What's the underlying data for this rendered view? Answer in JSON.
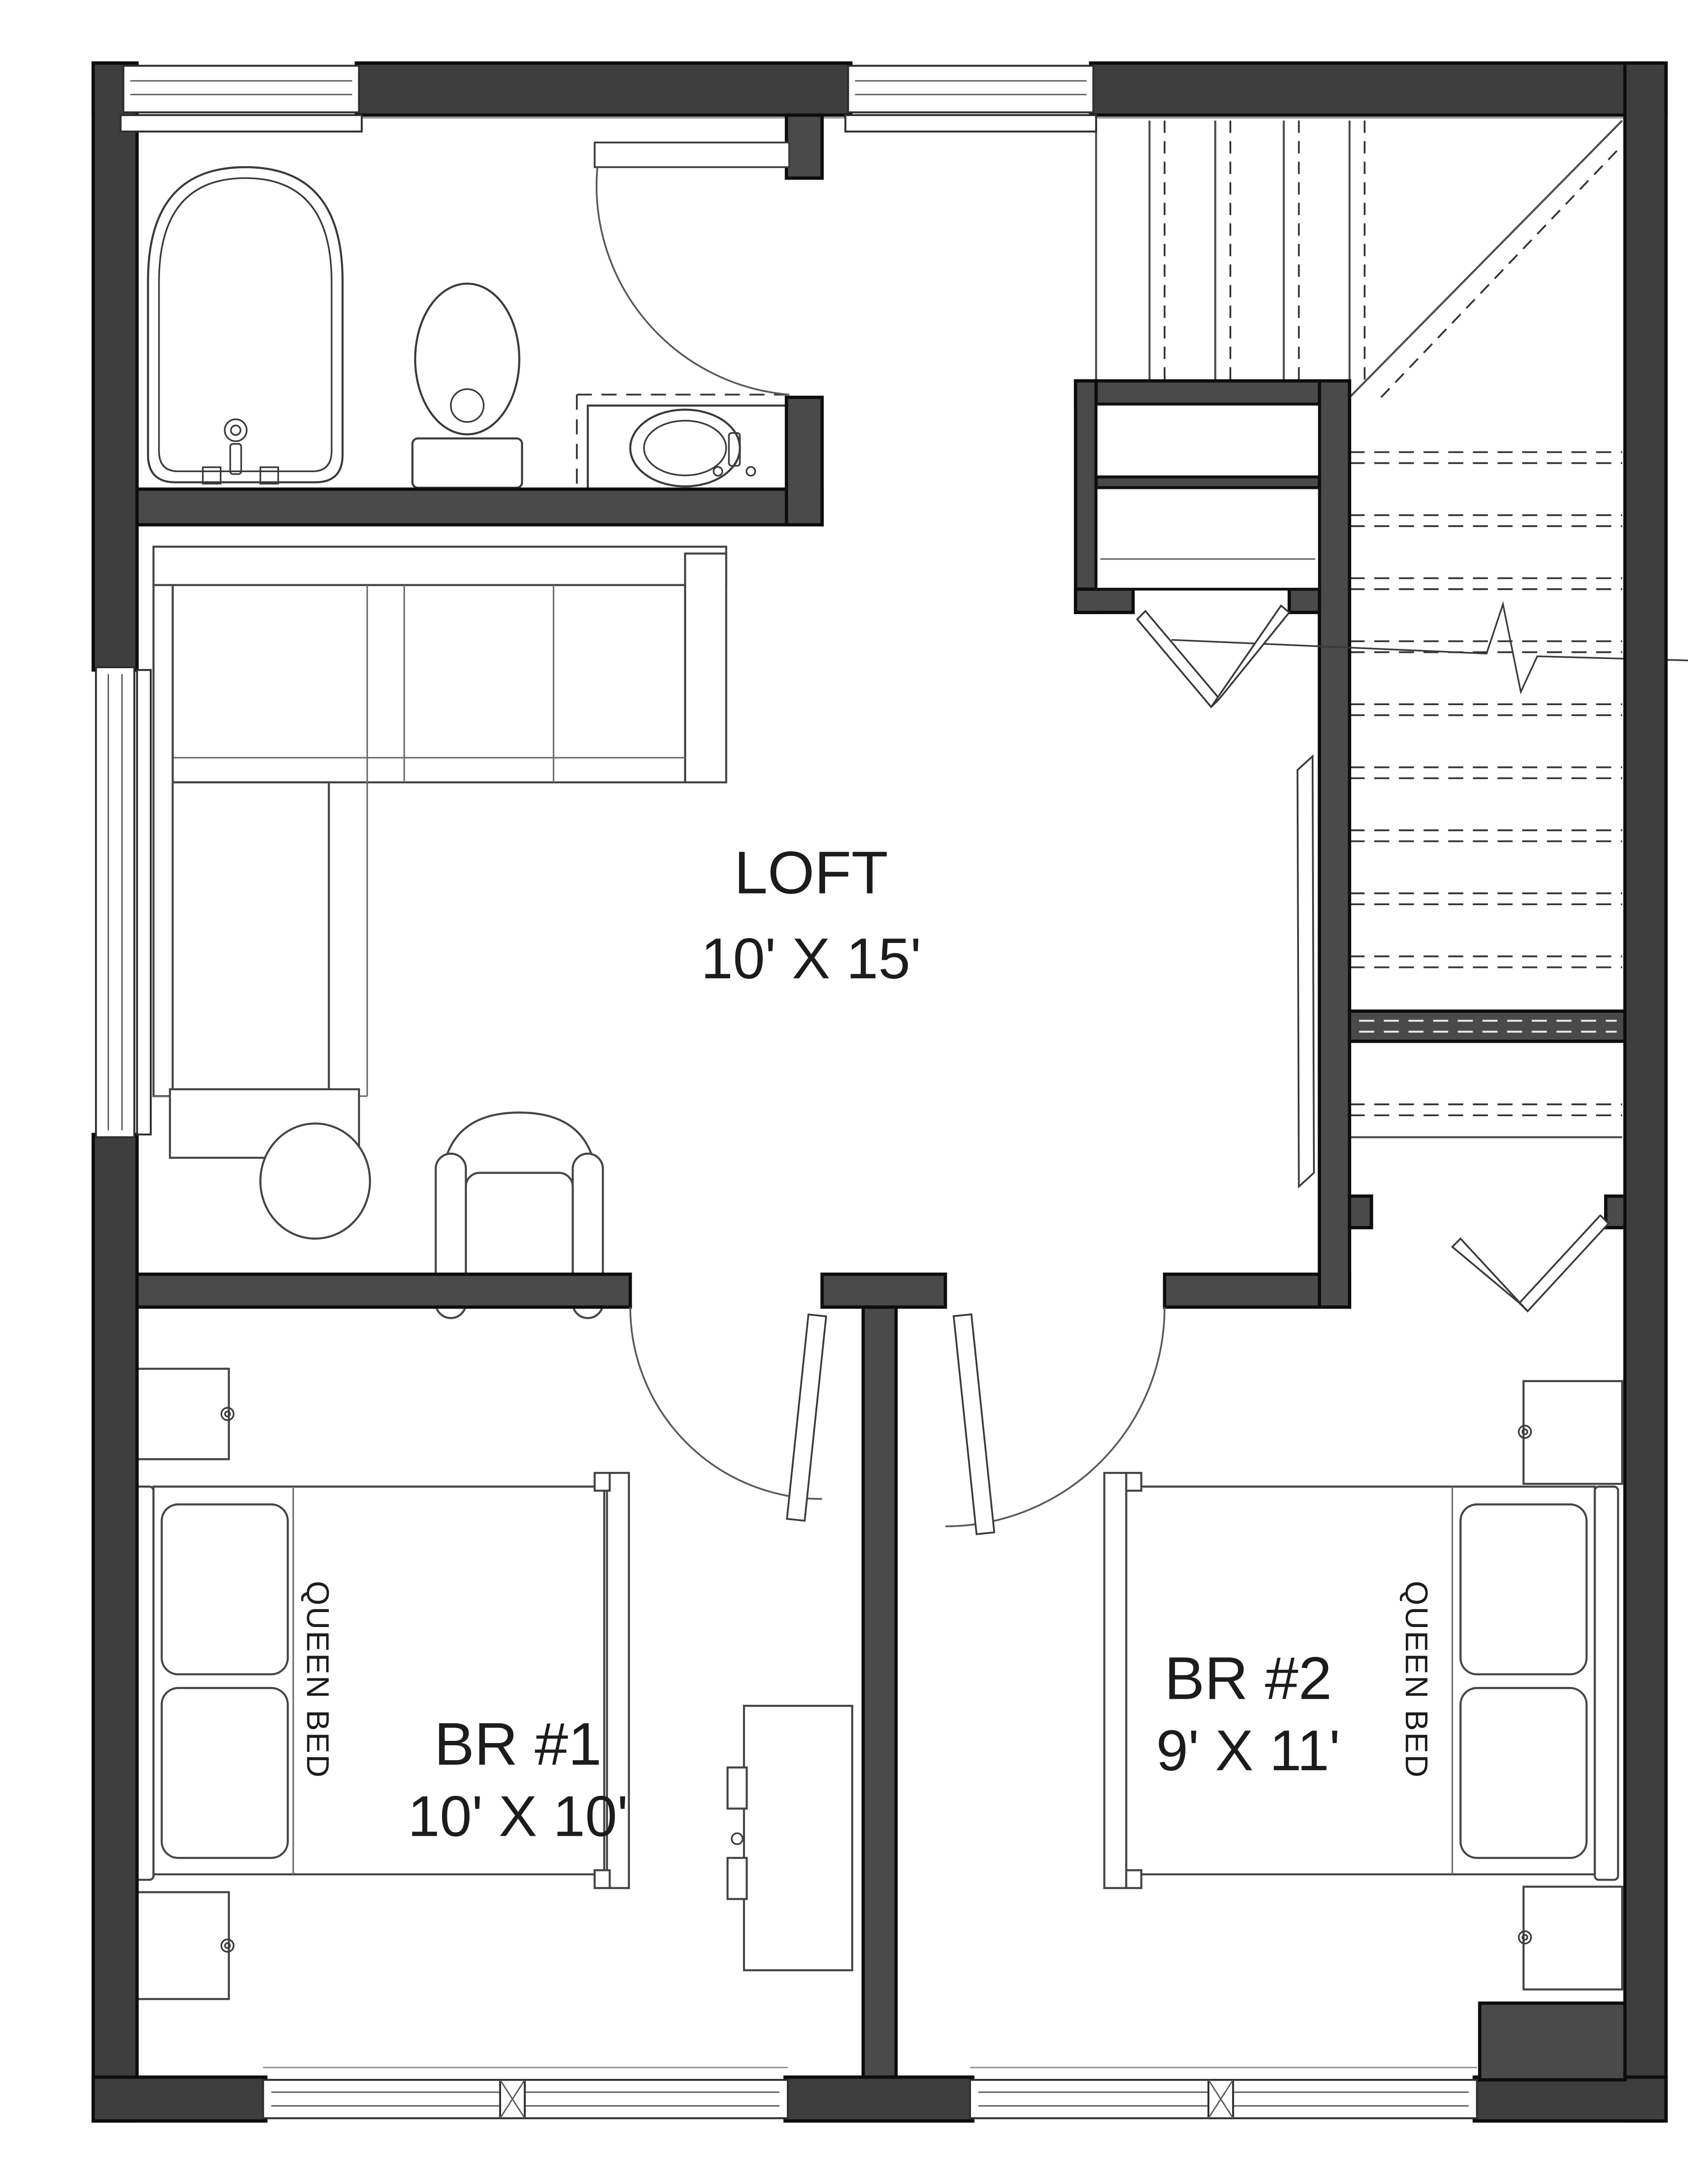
{
  "floorplan": {
    "rooms": [
      {
        "id": "loft",
        "name": "LOFT",
        "dimensions": "10' X 15'"
      },
      {
        "id": "br1",
        "name": "BR #1",
        "dimensions": "10' X 10'"
      },
      {
        "id": "br2",
        "name": "BR #2",
        "dimensions": "9' X 11'"
      }
    ],
    "furniture_labels": {
      "queen_bed_1": "QUEEN BED",
      "queen_bed_2": "QUEEN BED"
    },
    "colors": {
      "wall_fill": "#4a4a4a",
      "wall_fill_dark": "#3e3e3e",
      "wall_edge": "#0d0d0d",
      "line": "#3a3a3a",
      "light_line": "#8c8c8c",
      "background": "#ffffff",
      "text": "#1c1c1c"
    }
  }
}
